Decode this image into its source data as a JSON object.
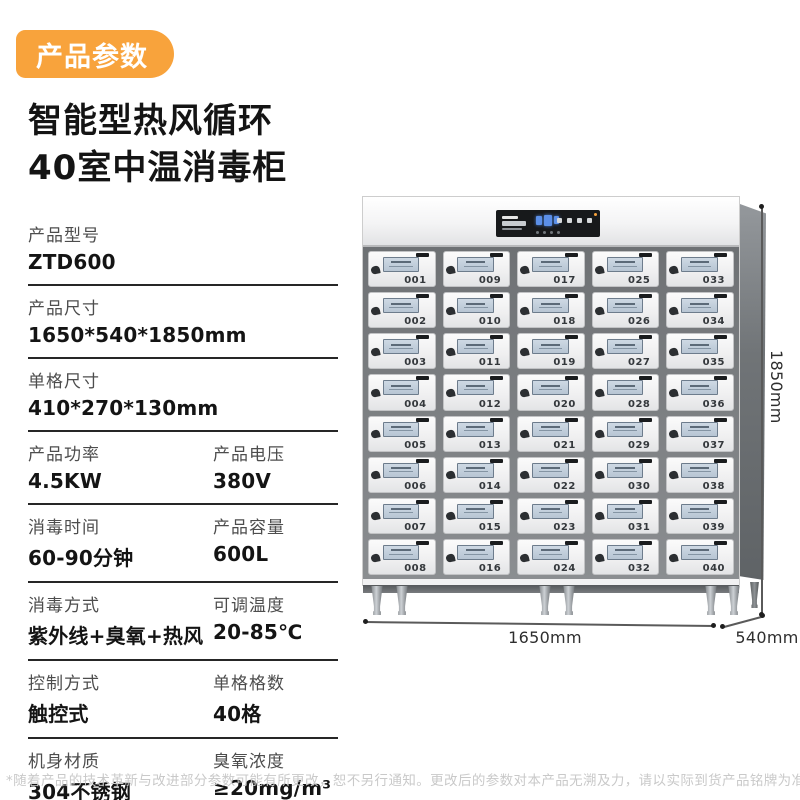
{
  "badge": {
    "label": "产品参数"
  },
  "title": {
    "line1": "智能型热风循环",
    "line2": "40室中温消毒柜"
  },
  "specs": {
    "rows": [
      {
        "cells": [
          {
            "label": "产品型号",
            "value": "ZTD600"
          }
        ]
      },
      {
        "cells": [
          {
            "label": "产品尺寸",
            "value": "1650*540*1850mm"
          }
        ]
      },
      {
        "cells": [
          {
            "label": "单格尺寸",
            "value": "410*270*130mm"
          }
        ]
      },
      {
        "cells": [
          {
            "label": "产品功率",
            "value": "4.5KW"
          },
          {
            "label": "产品电压",
            "value": "380V"
          }
        ]
      },
      {
        "cells": [
          {
            "label": "消毒时间",
            "value": "60-90分钟"
          },
          {
            "label": "产品容量",
            "value": "600L"
          }
        ]
      },
      {
        "cells": [
          {
            "label": "消毒方式",
            "value": "紫外线+臭氧+热风"
          },
          {
            "label": "可调温度",
            "value": "20-85℃"
          }
        ]
      },
      {
        "cells": [
          {
            "label": "控制方式",
            "value": "触控式"
          },
          {
            "label": "单格格数",
            "value": "40格"
          }
        ]
      },
      {
        "cells": [
          {
            "label": "机身材质",
            "value": "304不锈钢"
          },
          {
            "label": "臭氧浓度",
            "value": "≥20mg/m³"
          }
        ]
      }
    ]
  },
  "product": {
    "door_numbers": [
      "001",
      "002",
      "003",
      "004",
      "005",
      "006",
      "007",
      "008",
      "009",
      "010",
      "011",
      "012",
      "013",
      "014",
      "015",
      "016",
      "017",
      "018",
      "019",
      "020",
      "021",
      "022",
      "023",
      "024",
      "025",
      "026",
      "027",
      "028",
      "029",
      "030",
      "031",
      "032",
      "033",
      "034",
      "035",
      "036",
      "037",
      "038",
      "039",
      "040"
    ],
    "dimensions": {
      "width": "1650mm",
      "depth": "540mm",
      "height": "1850mm"
    }
  },
  "footnote": "*随着产品的技术革新与改进部分参数可能有所更改，恕不另行通知。更改后的参数对本产品无溯及力，请以实际到货产品铭牌为准",
  "colors": {
    "accent": "#F8A33C",
    "display_blue": "#5B8FE8"
  }
}
